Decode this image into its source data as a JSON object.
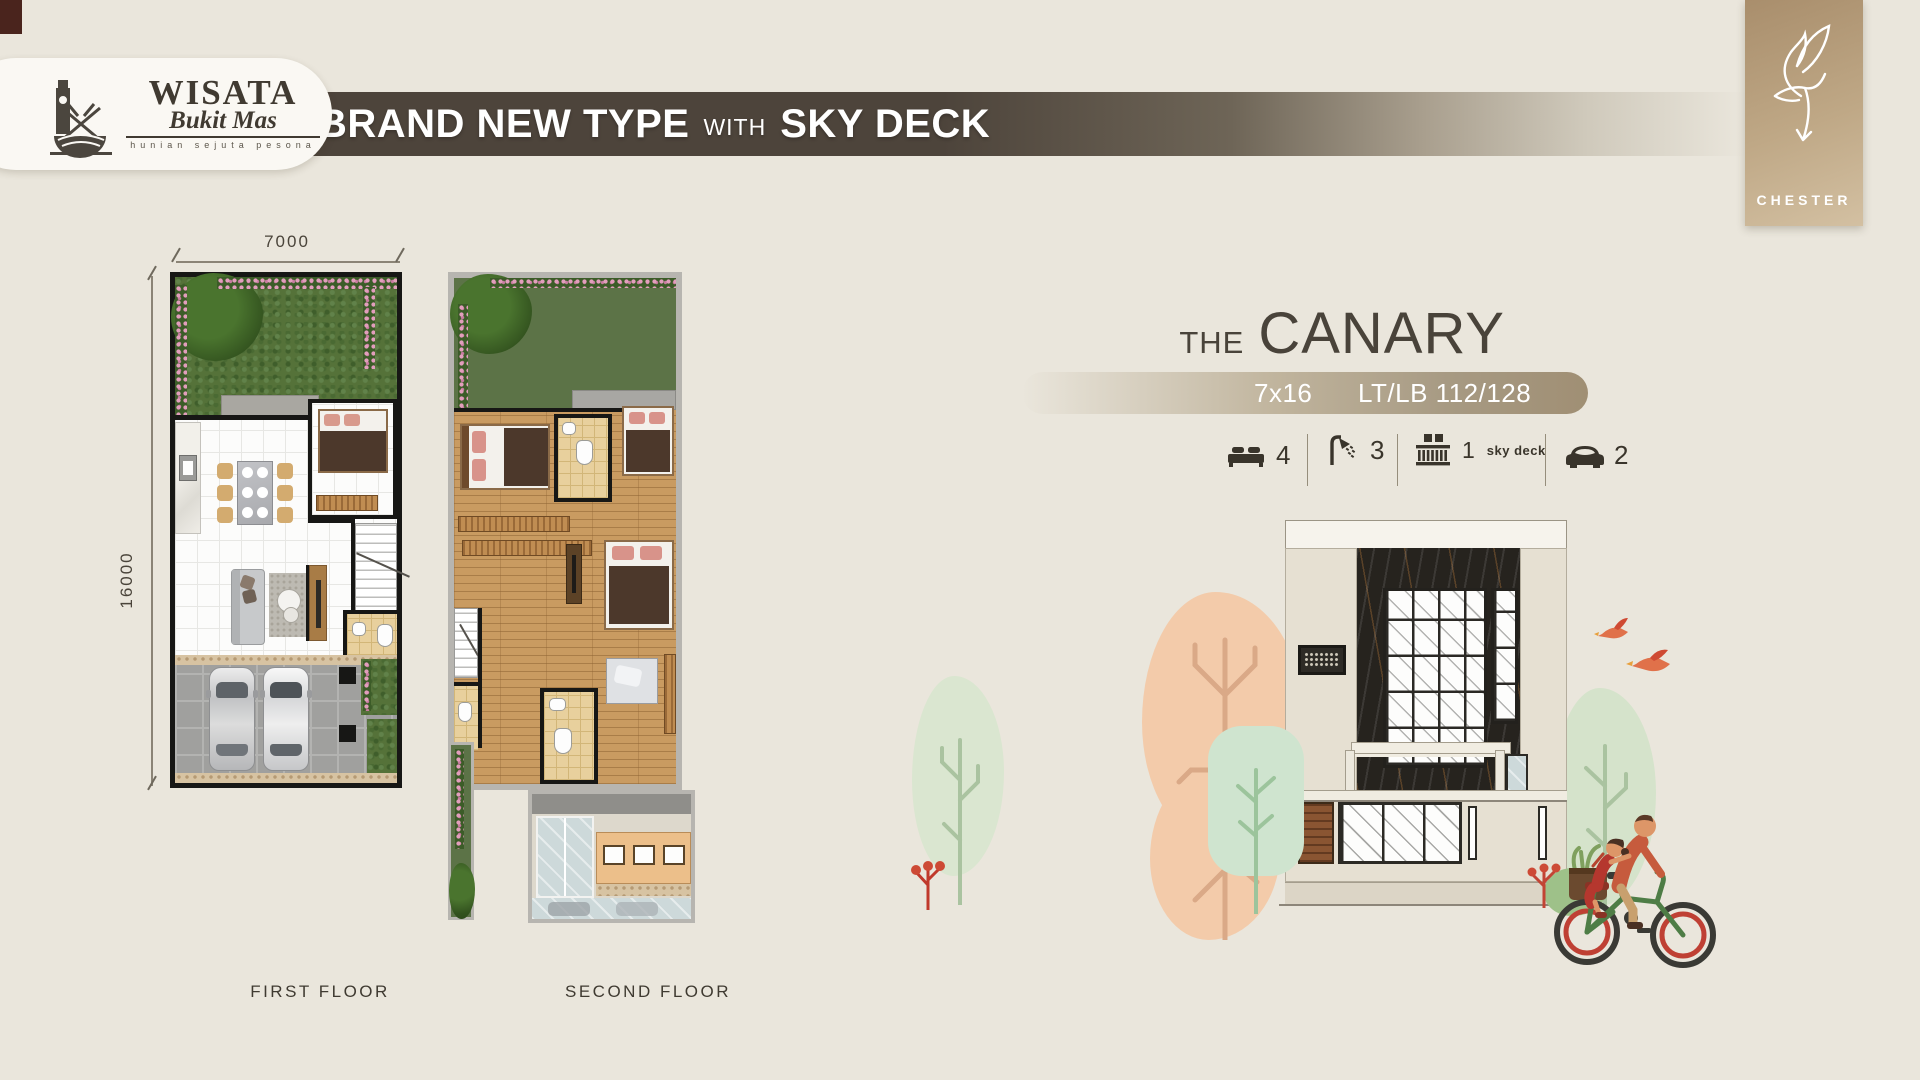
{
  "header": {
    "logo": {
      "title": "WISATA",
      "script": "Bukit Mas",
      "tagline": "hunian sejuta pesona"
    },
    "banner": {
      "bold1": "BRAND NEW TYPE",
      "small": "WITH",
      "bold2": "SKY DECK"
    },
    "chester": {
      "label": "CHESTER"
    }
  },
  "floorplans": {
    "width_dim": "7000",
    "height_dim": "16000",
    "first_floor_label": "FIRST FLOOR",
    "second_floor_label": "SECOND FLOOR"
  },
  "product": {
    "title_prefix": "THE",
    "title_name": "CANARY",
    "size": "7x16",
    "area": "LT/LB 112/128",
    "features": [
      {
        "icon": "bed-icon",
        "value": "4",
        "label": ""
      },
      {
        "icon": "shower-icon",
        "value": "3",
        "label": ""
      },
      {
        "icon": "skydeck-icon",
        "value": "1",
        "label": "sky deck"
      },
      {
        "icon": "car-icon",
        "value": "2",
        "label": ""
      }
    ]
  },
  "colors": {
    "background": "#eae6dc",
    "banner_dark": "#4d443b",
    "chester_gold": "#b79c7b",
    "title_text": "#49433a",
    "specs_bar": "#a79a83",
    "garden_green": "#557239",
    "wood_floor": "#c99b61",
    "accent_peach": "#f3cbaa",
    "accent_sage": "#d5e3cb"
  }
}
